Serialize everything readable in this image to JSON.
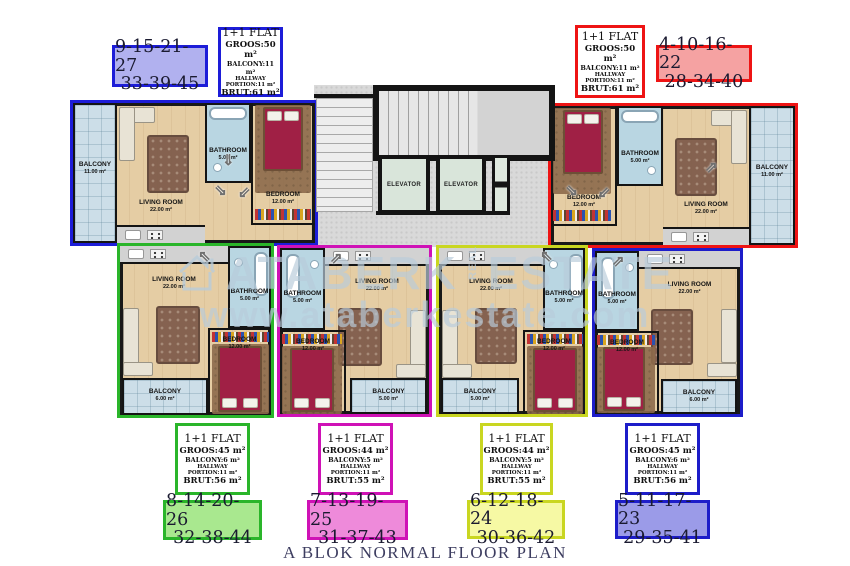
{
  "title": "A BLOK NORMAL FLOOR PLAN",
  "watermark": {
    "brand": "ATABERK",
    "real_vertical": "REAL",
    "estate": "ESTATE",
    "url": "www.ataberkestate.com"
  },
  "icons": {
    "door_swing_arrow": "⇗",
    "house_logo": "house-outline"
  },
  "core": {
    "elevator_left": "ELEVATOR",
    "elevator_right": "ELEVATOR"
  },
  "rooms": {
    "living": {
      "name": "LIVING ROOM",
      "area": "22.00 m²"
    },
    "bathroom": {
      "name": "BATHROOM",
      "area": "5.00 m²"
    },
    "bedroom": {
      "name": "BEDROOM",
      "area": "12.00 m²"
    },
    "balcony_11": {
      "name": "BALCONY",
      "area": "11.00 m²"
    },
    "balcony_6": {
      "name": "BALCONY",
      "area": "6.00 m²"
    },
    "balcony_5": {
      "name": "BALCONY",
      "area": "5.00 m²"
    }
  },
  "legend": {
    "top_left": {
      "outline_color": "#1d1dd8",
      "numbers_fill": "#b1b1ef",
      "numbers": [
        "9-15-21-27",
        "33-39-45"
      ],
      "flat_type": "1+1 FLAT",
      "groos": "GROOS:50 m²",
      "balcony": "BALCONY:11 m²",
      "hallway": "HALLWAY PORTION:11 m²",
      "brut": "BRUT:61 m²"
    },
    "top_right": {
      "outline_color": "#ee1414",
      "numbers_fill": "#f5a2a2",
      "numbers": [
        "4-10-16-22",
        "28-34-40"
      ],
      "flat_type": "1+1 FLAT",
      "groos": "GROOS:50 m²",
      "balcony": "BALCONY:11 m²",
      "hallway": "HALLWAY PORTION:11 m²",
      "brut": "BRUT:61 m²"
    },
    "bottom_1": {
      "outline_color": "#2ab52a",
      "numbers_fill": "#a9e88f",
      "numbers": [
        "8-14-20-26",
        "32-38-44"
      ],
      "flat_type": "1+1 FLAT",
      "groos": "GROOS:45 m²",
      "balcony": "BALCONY:6 m²",
      "hallway": "HALLWAY PORTION:11 m²",
      "brut": "BRUT:56 m²"
    },
    "bottom_2": {
      "outline_color": "#cf12b6",
      "numbers_fill": "#ee8ada",
      "numbers": [
        "7-13-19-25",
        "31-37-43"
      ],
      "flat_type": "1+1 FLAT",
      "groos": "GROOS:44 m²",
      "balcony": "BALCONY:5 m²",
      "hallway": "HALLWAY PORTION:11 m²",
      "brut": "BRUT:55 m²"
    },
    "bottom_3": {
      "outline_color": "#c9d621",
      "numbers_fill": "#f6f9a4",
      "numbers": [
        "6-12-18-24",
        "30-36-42"
      ],
      "flat_type": "1+1 FLAT",
      "groos": "GROOS:44 m²",
      "balcony": "BALCONY:5 m²",
      "hallway": "HALLWAY PORTION:11 m²",
      "brut": "BRUT:55 m²"
    },
    "bottom_4": {
      "outline_color": "#1d1dc9",
      "numbers_fill": "#9b9be8",
      "numbers": [
        "5-11-17-23",
        "29-35-41"
      ],
      "flat_type": "1+1 FLAT",
      "groos": "GROOS:45 m²",
      "balcony": "BALCONY:6 m²",
      "hallway": "HALLWAY PORTION:11 m²",
      "brut": "BRUT:56 m²"
    }
  }
}
